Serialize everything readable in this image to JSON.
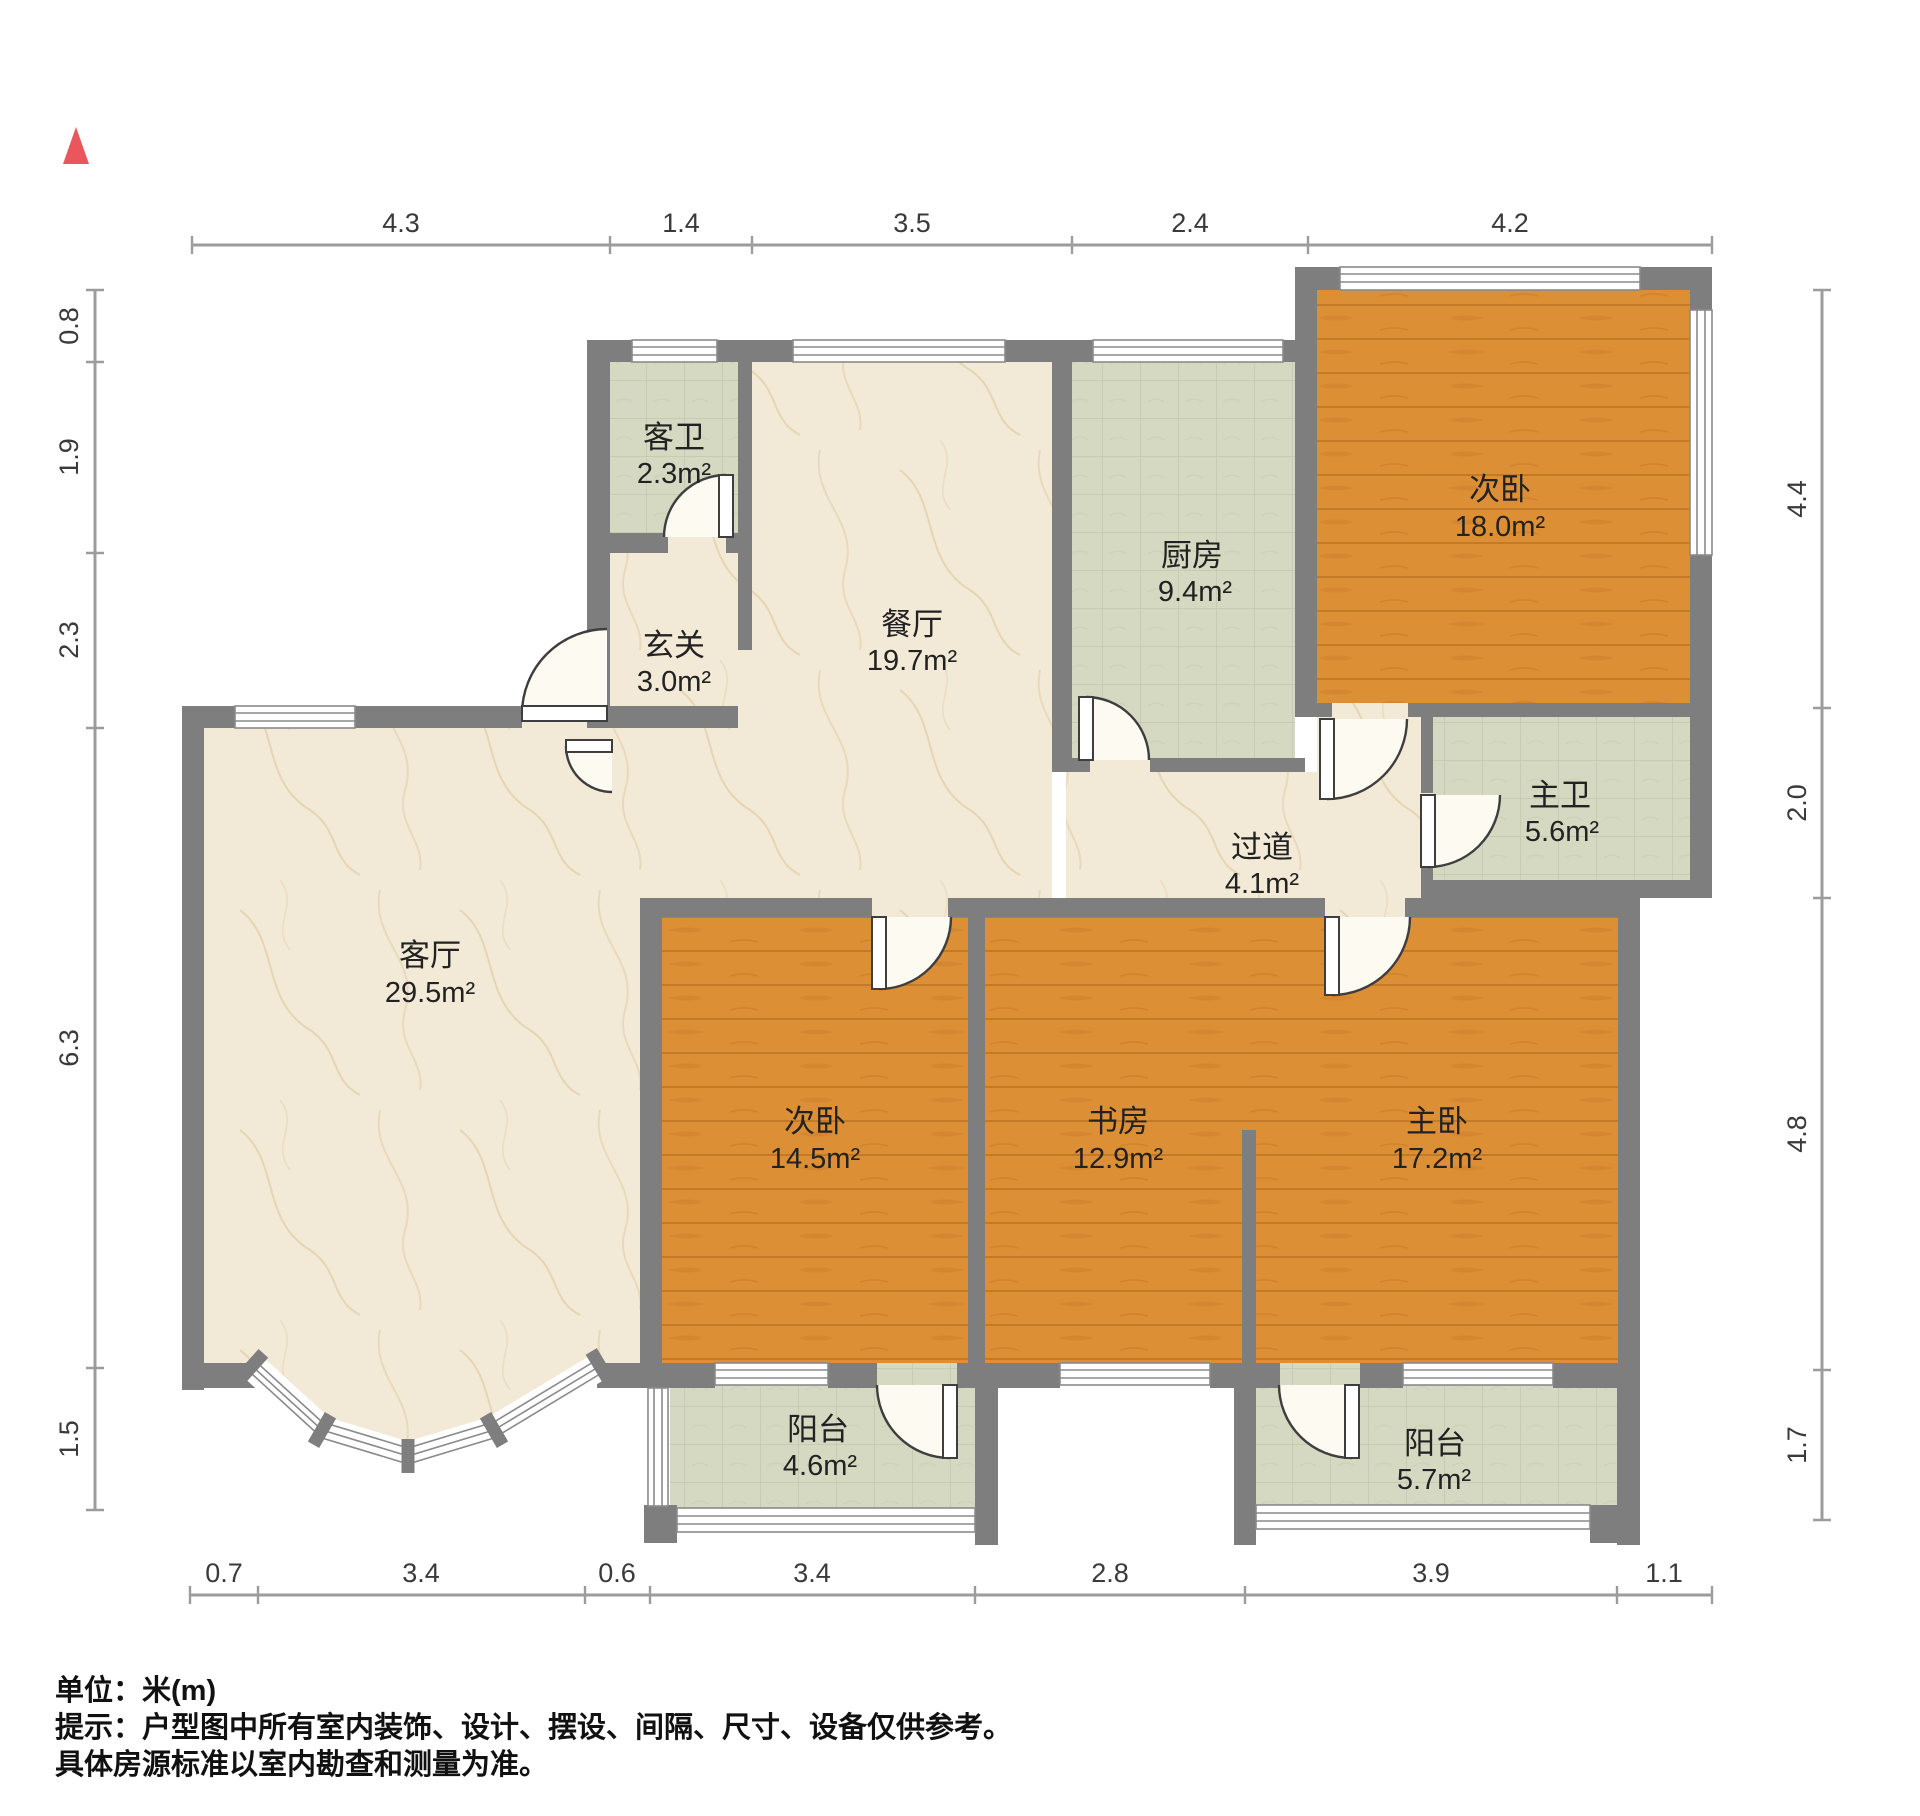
{
  "north_icon": "north-arrow",
  "dims": {
    "top": [
      "4.3",
      "1.4",
      "3.5",
      "2.4",
      "4.2"
    ],
    "left": [
      "0.8",
      "1.9",
      "2.3",
      "6.3",
      "1.5"
    ],
    "right": [
      "4.4",
      "2.0",
      "4.8",
      "1.7"
    ],
    "bottom": [
      "0.7",
      "3.4",
      "0.6",
      "3.4",
      "2.8",
      "3.9",
      "1.1"
    ]
  },
  "rooms": [
    {
      "name": "客卫",
      "area": "2.3m²"
    },
    {
      "name": "玄关",
      "area": "3.0m²"
    },
    {
      "name": "餐厅",
      "area": "19.7m²"
    },
    {
      "name": "厨房",
      "area": "9.4m²"
    },
    {
      "name": "次卧",
      "area": "18.0m²"
    },
    {
      "name": "主卫",
      "area": "5.6m²"
    },
    {
      "name": "过道",
      "area": "4.1m²"
    },
    {
      "name": "客厅",
      "area": "29.5m²"
    },
    {
      "name": "次卧",
      "area": "14.5m²"
    },
    {
      "name": "书房",
      "area": "12.9m²"
    },
    {
      "name": "主卧",
      "area": "17.2m²"
    },
    {
      "name": "阳台",
      "area": "4.6m²"
    },
    {
      "name": "阳台",
      "area": "5.7m²"
    }
  ],
  "notes": {
    "line1": "单位：米(m)",
    "line2": "提示：户型图中所有室内装饰、设计、摆设、间隔、尺寸、设备仅供参考。",
    "line3": "具体房源标准以室内勘查和测量为准。"
  },
  "colors": {
    "wall": "#7e7e7e",
    "marble": "#f2e9d6",
    "tile": "#d5d9c1",
    "wood": "#dd8f35",
    "window_line": "#8a8a8a",
    "dim_line": "#9c9c9c",
    "label_text": "#222222",
    "dim_text": "#3a3a3a",
    "north": "#e9565c",
    "door_line": "#3e3e3e"
  }
}
